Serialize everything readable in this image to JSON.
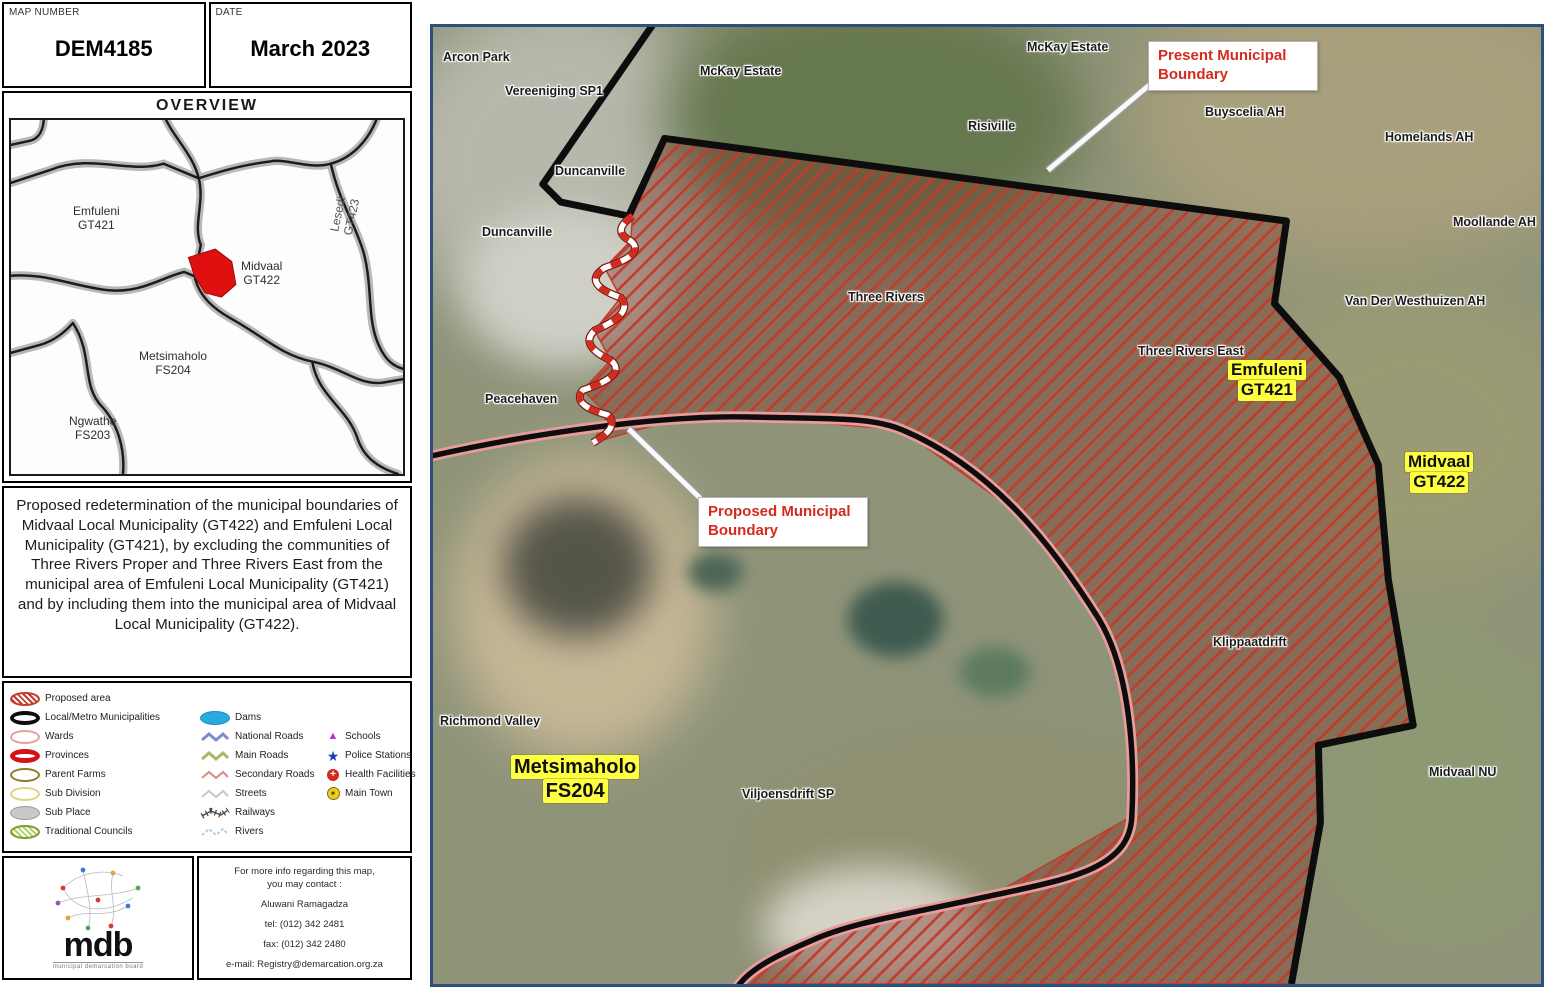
{
  "header": {
    "map_number_label": "MAP NUMBER",
    "map_number": "DEM4185",
    "date_label": "DATE",
    "date": "March 2023"
  },
  "overview": {
    "title": "OVERVIEW",
    "regions": [
      {
        "name": "Emfuleni",
        "code": "GT421"
      },
      {
        "name": "Midvaal",
        "code": "GT422"
      },
      {
        "name": "Lesedi",
        "code": "GT423"
      },
      {
        "name": "Metsimaholo",
        "code": "FS204"
      },
      {
        "name": "Ngwathe",
        "code": "FS203"
      }
    ]
  },
  "description": "Proposed redetermination of the municipal boundaries of Midvaal Local Municipality (GT422) and Emfuleni Local Municipality (GT421), by excluding the communities of Three Rivers Proper and Three Rivers East from the municipal area of Emfuleni Local Municipality (GT421) and by including them into the municipal area of Midvaal Local Municipality (GT422).",
  "legend": {
    "areas": [
      {
        "label": "Proposed area"
      },
      {
        "label": "Local/Metro Municipalities"
      },
      {
        "label": "Wards"
      },
      {
        "label": "Provinces"
      },
      {
        "label": "Parent Farms"
      },
      {
        "label": "Sub Division"
      },
      {
        "label": "Sub Place"
      },
      {
        "label": "Traditional Councils"
      }
    ],
    "lines": [
      {
        "label": "Dams"
      },
      {
        "label": "National Roads"
      },
      {
        "label": "Main Roads"
      },
      {
        "label": "Secondary Roads"
      },
      {
        "label": "Streets"
      },
      {
        "label": "Railways"
      },
      {
        "label": "Rivers"
      }
    ],
    "points": [
      {
        "label": "Schools"
      },
      {
        "label": "Police Stations"
      },
      {
        "label": "Health Facilities"
      },
      {
        "label": "Main Town"
      }
    ]
  },
  "logo": {
    "text": "mdb",
    "tagline": "municipal demarcation board"
  },
  "contact": {
    "line1": "For more info regarding this map,",
    "line2": "you may contact :",
    "name": "Aluwani Ramagadza",
    "tel": "tel: (012) 342 2481",
    "fax": "fax: (012) 342 2480",
    "email": "e-mail: Registry@demarcation.org.za"
  },
  "map": {
    "labels": [
      {
        "text": "Arcon Park"
      },
      {
        "text": "Vereeniging SP1"
      },
      {
        "text": "McKay Estate"
      },
      {
        "text": "McKay Estate"
      },
      {
        "text": "Risiville"
      },
      {
        "text": "Buyscelia AH"
      },
      {
        "text": "Homelands AH"
      },
      {
        "text": "Moollande AH"
      },
      {
        "text": "Duncanville"
      },
      {
        "text": "Duncanville"
      },
      {
        "text": "Three Rivers"
      },
      {
        "text": "Three Rivers East"
      },
      {
        "text": "Van Der Westhuizen AH"
      },
      {
        "text": "Peacehaven"
      },
      {
        "text": "Klippaatdrift"
      },
      {
        "text": "Richmond Valley"
      },
      {
        "text": "Viljoensdrift SP"
      },
      {
        "text": "Midvaal NU"
      }
    ],
    "area_labels": [
      {
        "line1": "Emfuleni",
        "line2": "GT421"
      },
      {
        "line1": "Midvaal",
        "line2": "GT422"
      },
      {
        "line1": "Metsimaholo",
        "line2": "FS204"
      }
    ],
    "callouts": [
      {
        "text": "Present Municipal Boundary"
      },
      {
        "text": "Proposed Municipal Boundary"
      }
    ]
  },
  "colors": {
    "accent_red": "#d42b1e",
    "boundary_black": "#0d0d0d",
    "hatch_red": "#c23b2c",
    "highlight_yellow": "#ffff42",
    "map_border_blue": "#2e4f7e",
    "dam_blue": "#29abe2"
  }
}
